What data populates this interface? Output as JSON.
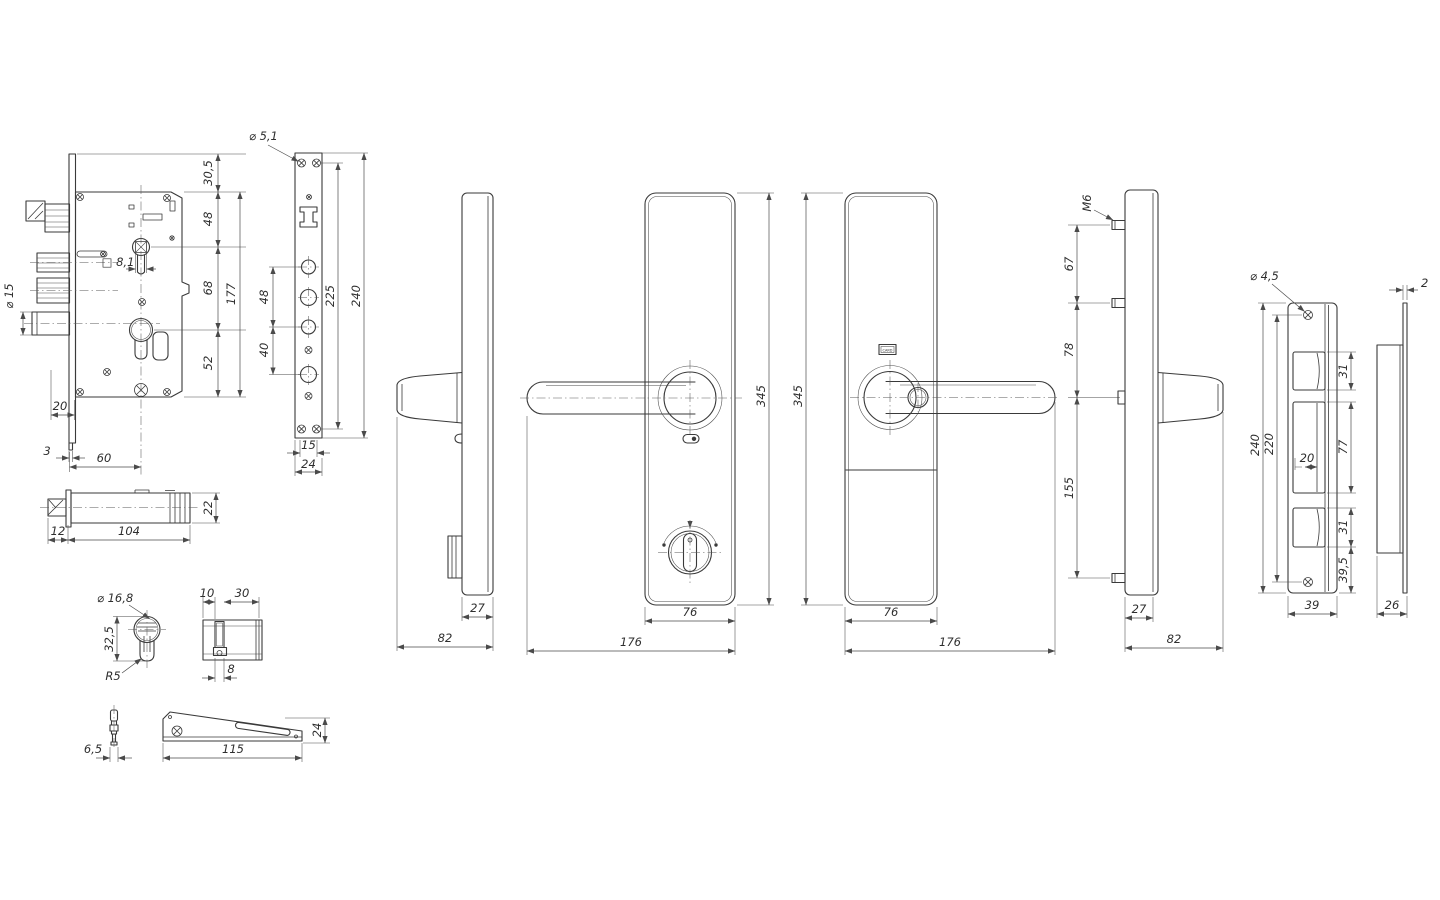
{
  "title": "Door lock set technical drawing",
  "colors": {
    "background": "#ffffff",
    "line": "#3a3a3a",
    "dimension": "#4a4a4a",
    "text": "#2e2e2e"
  },
  "views": {
    "lock_body_front": {
      "dims": {
        "bolt_dia": "⌀ 15",
        "top_offset": "30,5",
        "follower_span": "48",
        "cylinder_span": "68",
        "height": "177",
        "bottom_span": "52",
        "square": "□ 8,1",
        "backset_20": "20",
        "plate_thickness": "3",
        "backset_60": "60"
      }
    },
    "faceplate": {
      "dims": {
        "screw_dia": "⌀ 5,1",
        "span_48": "48",
        "span_40": "40",
        "screw_span": "225",
        "length": "240",
        "slot_width": "15",
        "width": "24"
      }
    },
    "lock_body_side": {
      "dims": {
        "height": "22",
        "latch": "12",
        "depth": "104"
      }
    },
    "cylinder_front": {
      "dims": {
        "dia": "⌀ 16,8",
        "height": "32,5",
        "radius": "R5"
      }
    },
    "cylinder_side": {
      "dims": {
        "len_10": "10",
        "len_30": "30",
        "cam": "8"
      }
    },
    "key": {
      "dims": {
        "width": "6,5"
      }
    },
    "strike_plate": {
      "dims": {
        "length": "115",
        "width": "24"
      }
    },
    "side_view_a": {
      "dims": {
        "depth_27": "27",
        "depth_82": "82"
      }
    },
    "interior_front": {
      "dims": {
        "height": "345",
        "plate_width": "76",
        "width": "176"
      }
    },
    "exterior_front": {
      "dims": {
        "height": "345",
        "plate_width": "76",
        "width": "176"
      },
      "card_label": "CARD"
    },
    "side_view_b": {
      "dims": {
        "thread": "M6",
        "span_67": "67",
        "span_78": "78",
        "span_155": "155",
        "depth_27": "27",
        "depth_82": "82"
      }
    },
    "box_strike_front": {
      "dims": {
        "screw_dia": "⌀ 4,5",
        "length": "240",
        "screw_span": "220",
        "cut_31a": "31",
        "cut_77": "77",
        "tongue_20": "20",
        "cut_31b": "31",
        "offset_39_5": "39,5",
        "width": "39"
      }
    },
    "box_strike_side": {
      "dims": {
        "thickness": "2",
        "depth": "26"
      }
    }
  }
}
